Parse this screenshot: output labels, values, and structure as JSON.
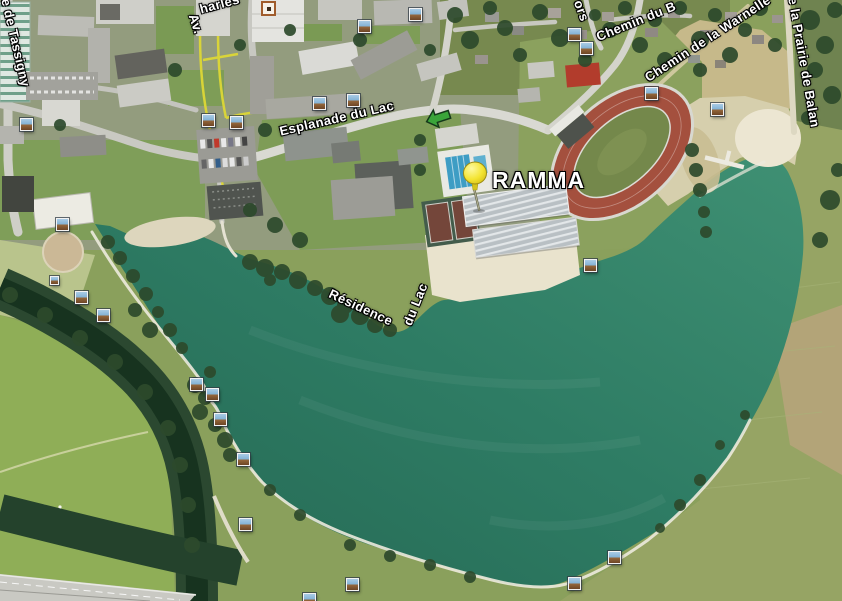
{
  "map": {
    "type": "satellite-aerial-view",
    "marker_label": "RAMMA",
    "road_labels": {
      "esplanade": "Esplanade du Lac",
      "residence_part1": "Résidence",
      "residence_part2": "du Lac",
      "avenue_part1": "Av.",
      "avenue_part2": "harles",
      "tassigny": "e de Tassigny",
      "ors": "ors",
      "chemin_du_b": "Chemin du B",
      "warnelle": "Chemin de la Warnelle",
      "prairie_de_balan": "e la Prairie de Balan"
    },
    "icons": {
      "photo_icon": "photo-thumbnail-square",
      "poi_dot_icon": "orange-square-dot",
      "direction_arrow_icon": "green-left-arrow",
      "pushpin_icon": "yellow-pushpin"
    },
    "colors": {
      "lake_water": "#2f8069",
      "river_water": "#17331f",
      "running_track": "#a4503e",
      "sand": "#e9e3cd",
      "pushpin_yellow": "#efdc2e",
      "road_overlay_yellow": "#ddd736",
      "label_text": "#ffffff"
    },
    "photo_markers": [
      [
        20,
        118
      ],
      [
        202,
        114
      ],
      [
        230,
        116
      ],
      [
        313,
        97
      ],
      [
        347,
        94
      ],
      [
        358,
        20
      ],
      [
        409,
        8
      ],
      [
        568,
        28
      ],
      [
        580,
        42
      ],
      [
        645,
        87
      ],
      [
        711,
        103
      ],
      [
        584,
        259
      ],
      [
        56,
        218
      ],
      [
        50,
        276,
        9
      ],
      [
        75,
        291
      ],
      [
        97,
        309
      ],
      [
        190,
        378
      ],
      [
        206,
        388
      ],
      [
        214,
        413
      ],
      [
        237,
        453
      ],
      [
        239,
        518
      ],
      [
        303,
        593
      ],
      [
        346,
        578
      ],
      [
        568,
        577
      ],
      [
        608,
        551
      ]
    ]
  }
}
